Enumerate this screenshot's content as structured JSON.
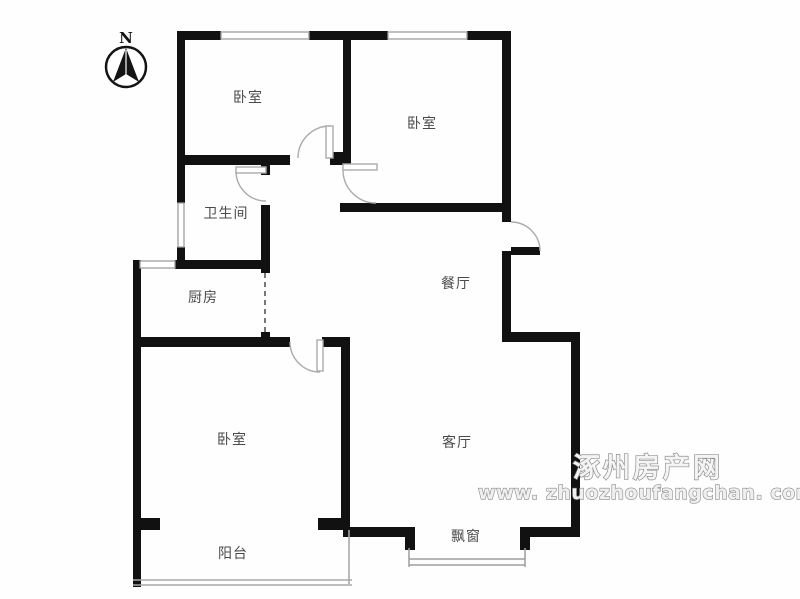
{
  "compass": {
    "label": "N"
  },
  "rooms": [
    {
      "id": "bedroom-top-left",
      "label": "卧室"
    },
    {
      "id": "bedroom-top-right",
      "label": "卧室"
    },
    {
      "id": "bathroom",
      "label": "卫生间"
    },
    {
      "id": "kitchen",
      "label": "厨房"
    },
    {
      "id": "dining-room",
      "label": "餐厅"
    },
    {
      "id": "bedroom-bottom-left",
      "label": "卧室"
    },
    {
      "id": "living-room",
      "label": "客厅"
    },
    {
      "id": "balcony",
      "label": "阳台"
    },
    {
      "id": "bay-window",
      "label": "飘窗"
    }
  ],
  "watermark": {
    "site_name": "涿州房产网",
    "site_url": "www. zhuozhoufangchan. com"
  },
  "colors": {
    "wall": "#111111",
    "window": "#9e9e9e",
    "door_arc": "#ababab",
    "label": "#4a4a4a",
    "watermark": "#8f8f8f"
  }
}
